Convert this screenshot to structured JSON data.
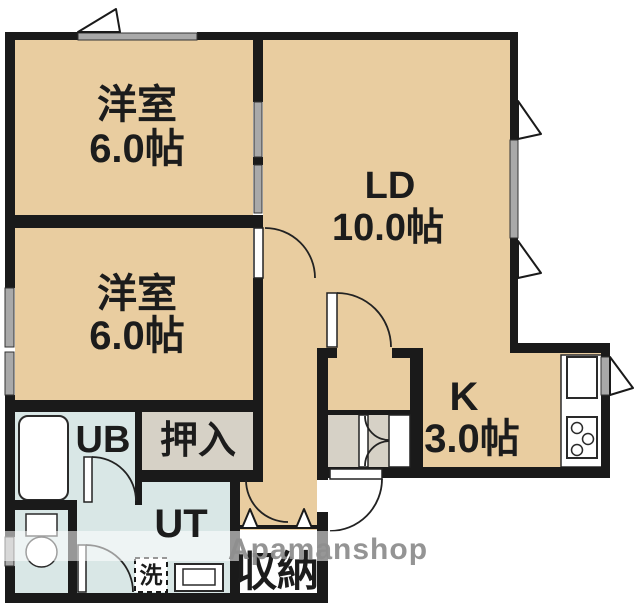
{
  "title": "2LDK apartment floor plan",
  "rooms": {
    "bedroom1": {
      "name": "洋室",
      "size": "6.0帖"
    },
    "bedroom2": {
      "name": "洋室",
      "size": "6.0帖"
    },
    "living_dining": {
      "name": "LD",
      "size": "10.0帖"
    },
    "kitchen": {
      "name": "K",
      "size": "3.0帖"
    },
    "unit_bath": {
      "label": "UB"
    },
    "oshiire_closet": {
      "label": "押入"
    },
    "utility": {
      "label": "UT"
    },
    "storage": {
      "label": "収納"
    },
    "washer": {
      "label": "洗"
    }
  },
  "watermark": {
    "text": "Apamanshop"
  },
  "colors": {
    "wall": "#1a1a1a",
    "floor": "#e9cda0",
    "closet": "#d6d1c6",
    "wet_area": "#d9e7e6",
    "window": "#a9a9a9",
    "watermark_text": "#8f8f8f",
    "background": "#ffffff",
    "line": "#222222"
  }
}
